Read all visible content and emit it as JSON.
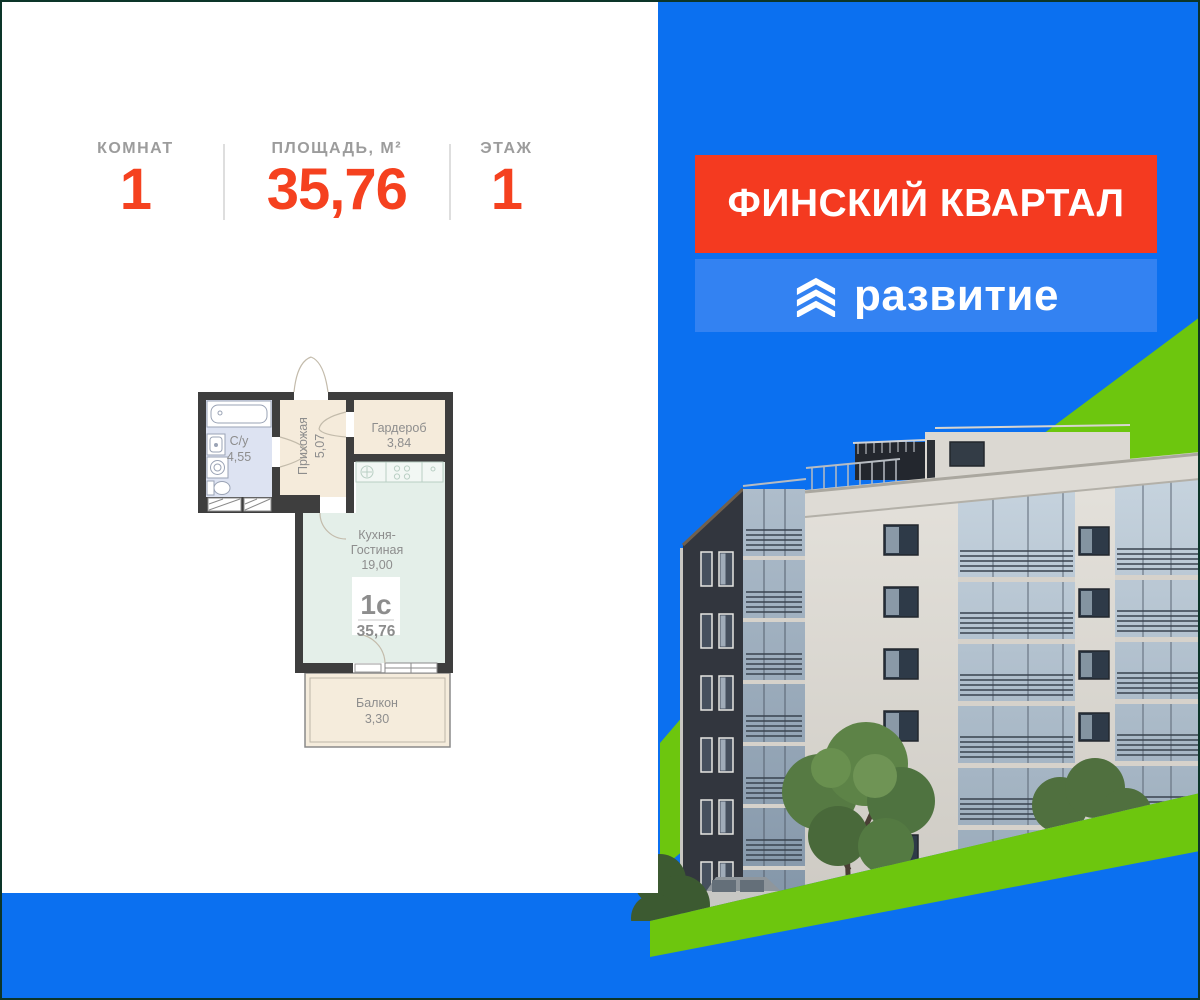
{
  "stats": {
    "items": [
      {
        "label": "КОМНАТ",
        "value": "1"
      },
      {
        "label": "ПЛОЩАДЬ, М²",
        "value": "35,76"
      },
      {
        "label": "ЭТАЖ",
        "value": "1"
      }
    ]
  },
  "floorplan": {
    "rooms": [
      {
        "name": "С/у",
        "area": "4,55"
      },
      {
        "name": "Прихожая",
        "area": "5,07"
      },
      {
        "name": "Гардероб",
        "area": "3,84"
      },
      {
        "name_line1": "Кухня-",
        "name_line2": "Гостиная",
        "area": "19,00"
      },
      {
        "name": "Балкон",
        "area": "3,30"
      }
    ],
    "badge": {
      "type": "1с",
      "total_area": "35,76"
    }
  },
  "branding": {
    "project_name": "ФИНСКИЙ КВАРТАЛ",
    "developer_name": "развитие",
    "logo_icon": "triple-chevron-up-icon"
  },
  "colors": {
    "accent_red": "#f43a20",
    "stat_number_red": "#f5411f",
    "panel_blue": "#0b70f0",
    "banner_blue": "#3382f2",
    "brand_green": "#6dc60e",
    "frame_green": "#0c3529",
    "plan_wall": "#3e3e3e",
    "room_bath_fill": "#dde3f2",
    "room_hall_fill": "#f5ebdb",
    "room_living_fill": "#e4efe9"
  }
}
